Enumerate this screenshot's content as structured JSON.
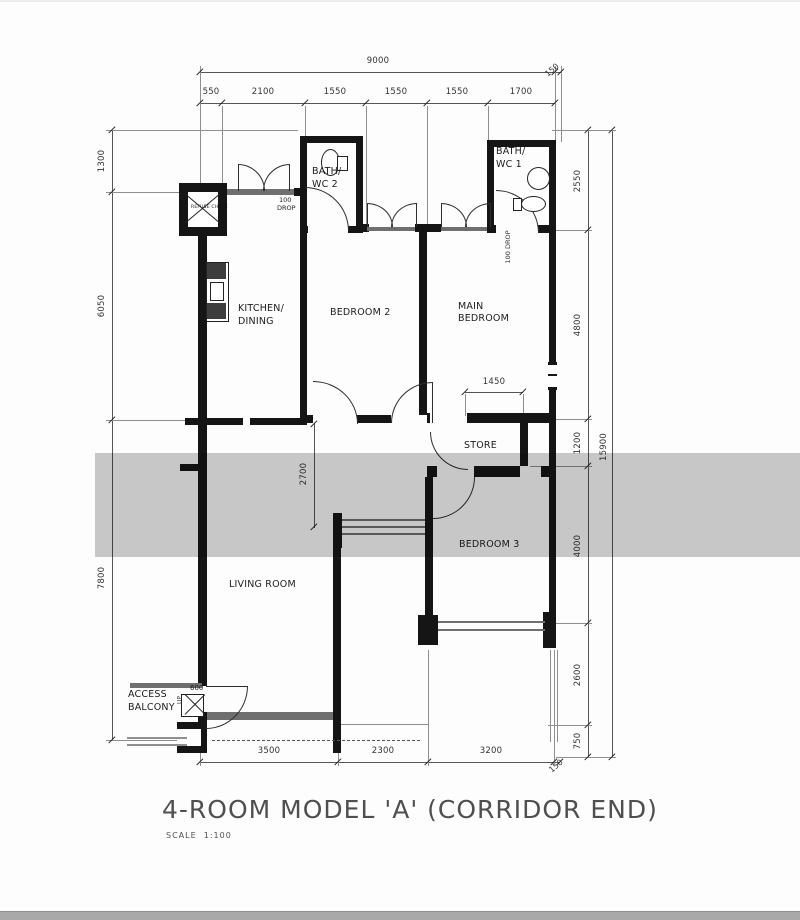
{
  "title": {
    "text": "4-ROOM MODEL 'A' (CORRIDOR END)",
    "scale_label": "SCALE",
    "scale_value": "1:100"
  },
  "rooms": {
    "kitchen": [
      "KITCHEN/",
      "DINING"
    ],
    "bedroom2": "BEDROOM 2",
    "main_bedroom": [
      "MAIN",
      "BEDROOM"
    ],
    "bath_wc_2": [
      "BATH/",
      "WC 2"
    ],
    "bath_wc_1": [
      "BATH/",
      "WC 1"
    ],
    "store": "STORE",
    "bedroom3": "BEDROOM 3",
    "living": "LIVING ROOM",
    "access_balcony": [
      "ACCESS",
      "BALCONY"
    ],
    "refuse_chute": "REFUSE CHUTE"
  },
  "annotations": {
    "drop_bath2": [
      "100",
      "DROP"
    ],
    "drop_bath1": "100 DROP",
    "entry_step": "600",
    "up": "UP",
    "main_bed_clear": "1450",
    "living_clear": "2700"
  },
  "dims": {
    "top": {
      "total": "9000",
      "segments": [
        "550",
        "2100",
        "1550",
        "1550",
        "1550",
        "1700"
      ],
      "corner": "150"
    },
    "left": [
      "1300",
      "6050",
      "7800"
    ],
    "right": {
      "segments": [
        "2550",
        "4800",
        "1200",
        "4000",
        "2600",
        "750"
      ],
      "total": "15900",
      "corner": "150"
    },
    "bottom": [
      "3500",
      "2300",
      "3200"
    ]
  },
  "colors": {
    "wall": "#151515",
    "dim_line": "#555555",
    "label": "#1c1c1c",
    "watermark_band": "#c9c9c9",
    "footer_bar": "#a9a9a9"
  }
}
